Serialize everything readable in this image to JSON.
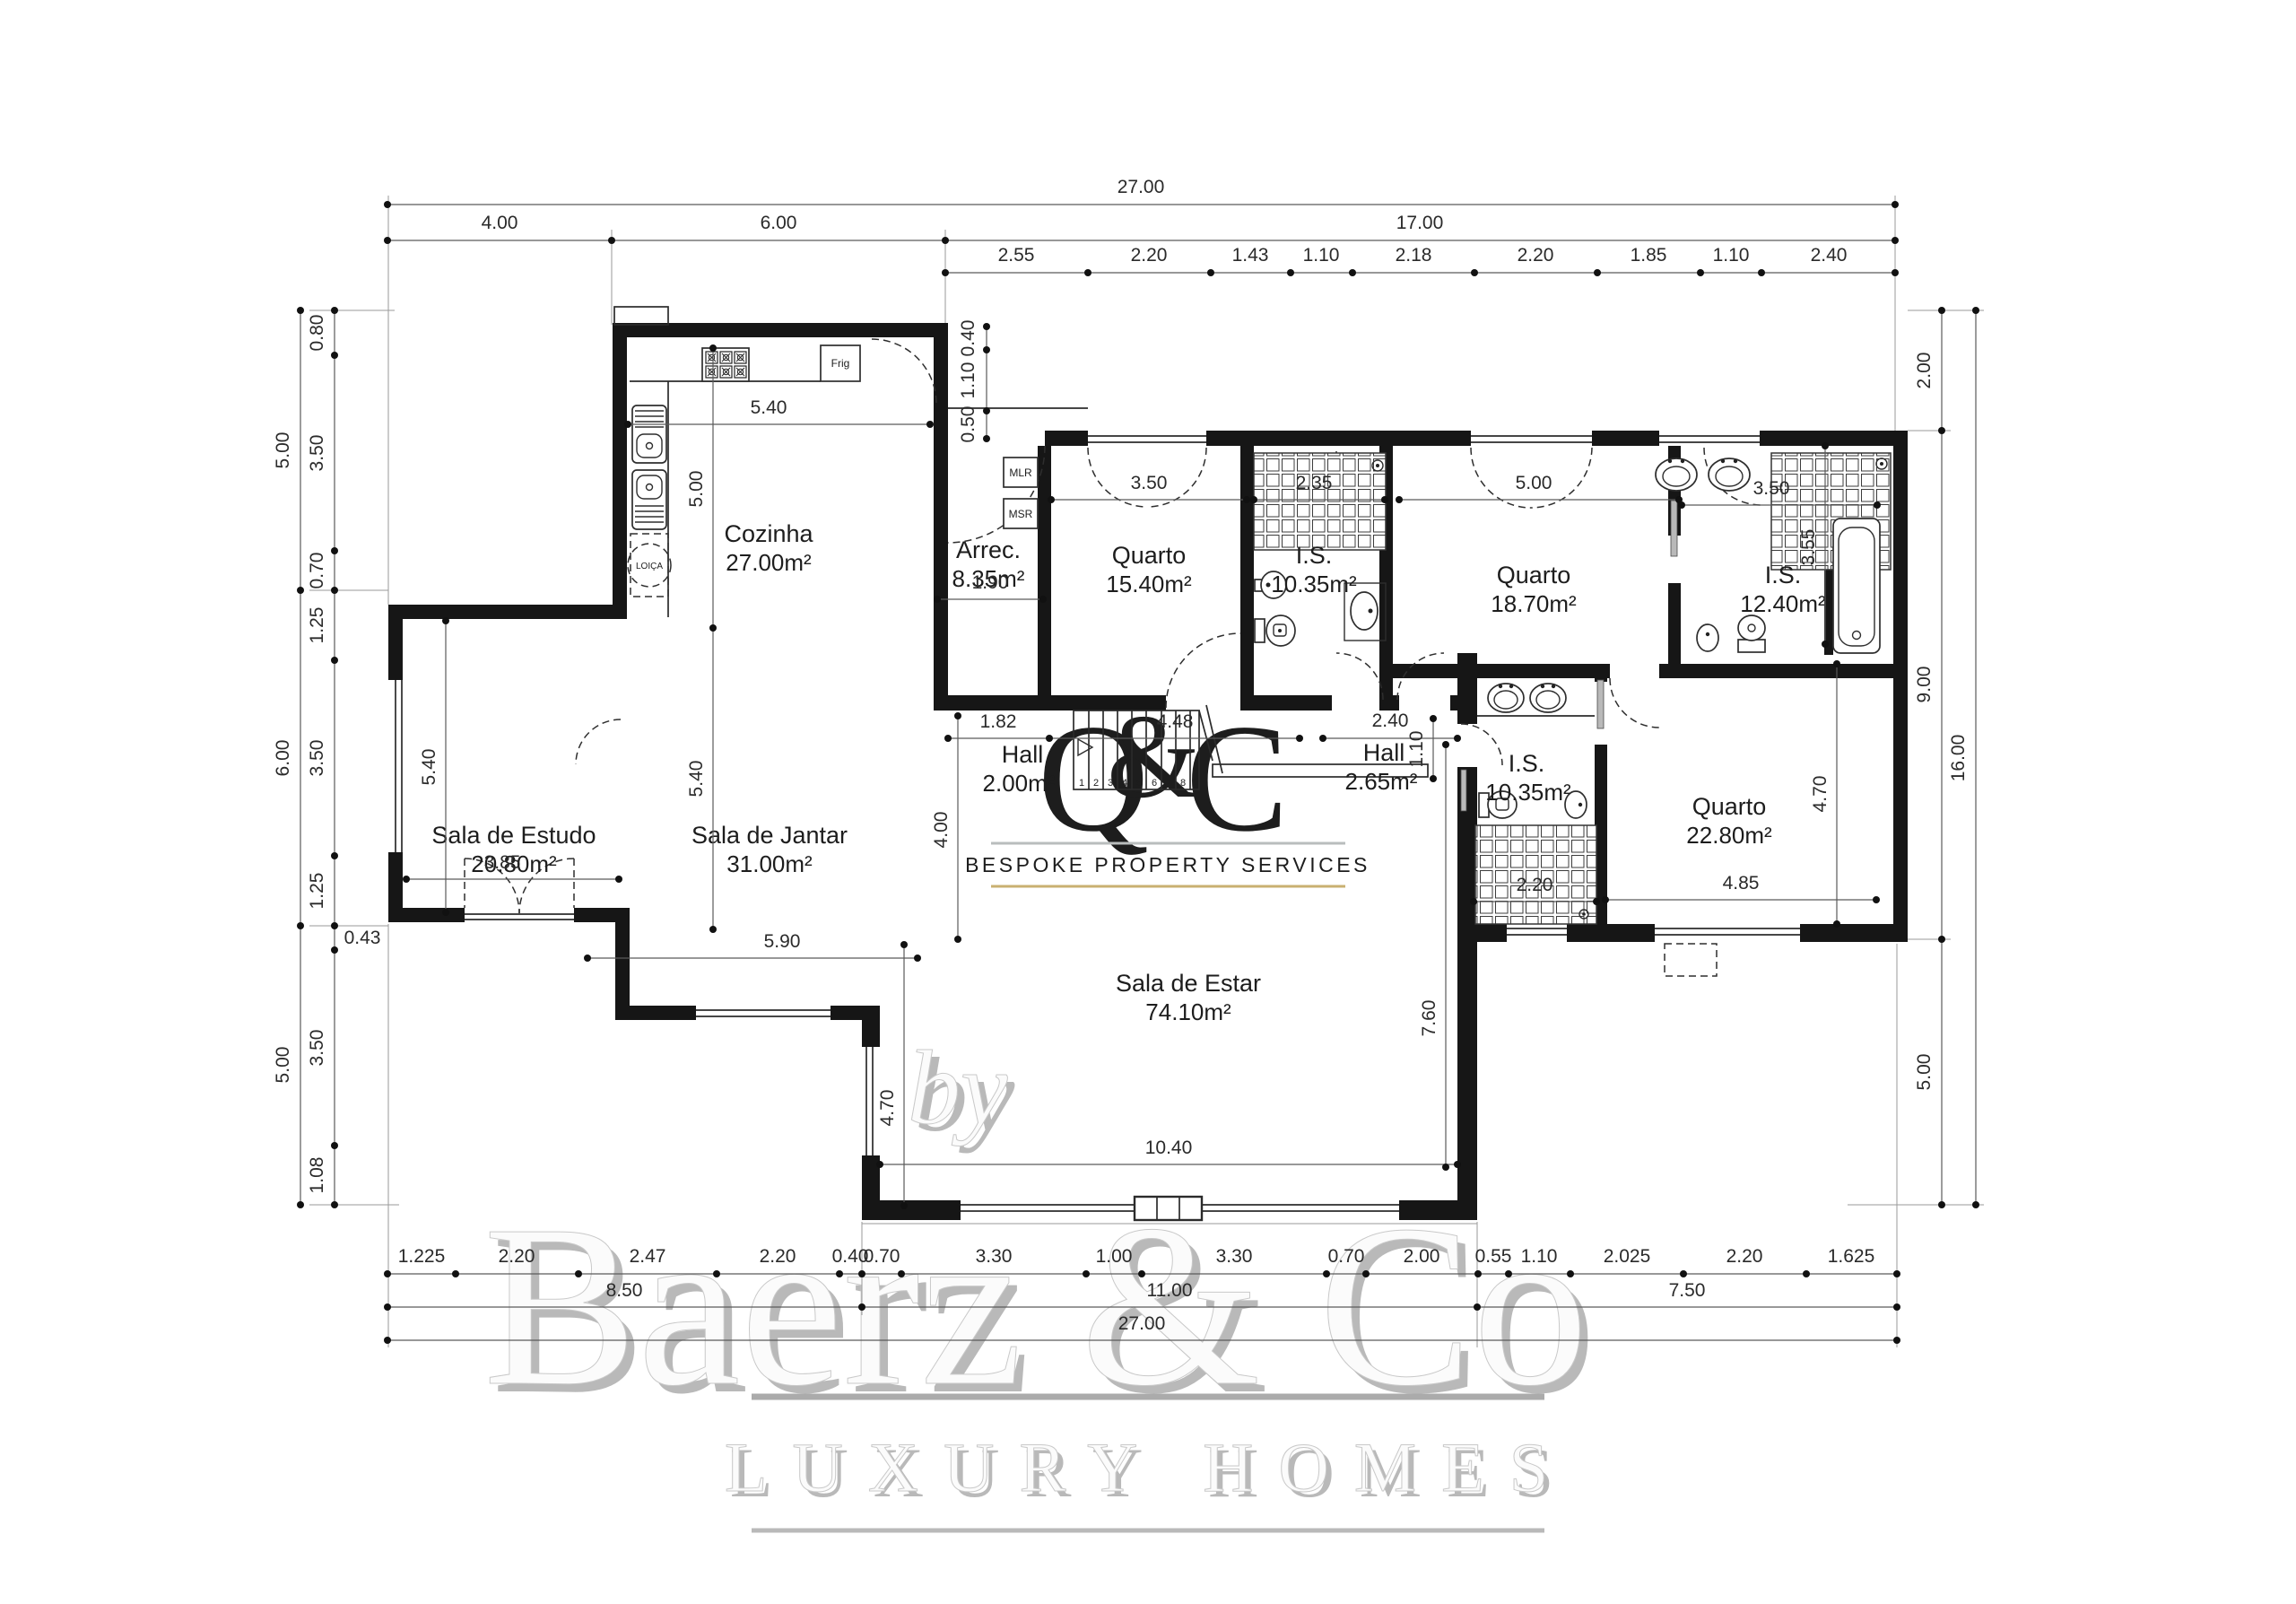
{
  "watermark": {
    "by": "by",
    "brand": "Baerz & Co",
    "tagline": "LUXURY HOMES",
    "logo": {
      "q": "Q",
      "amp": "&",
      "c": "C",
      "tagline": "BESPOKE PROPERTY SERVICES"
    },
    "colors": {
      "sage": "#93A39B",
      "gold_light": "#D8B36A",
      "gold_dark": "#A67F3B",
      "tagline_gray": "#A2ABAB",
      "rule_gray": "#B9BDBD",
      "rule_gold": "#C9B071"
    }
  },
  "rooms": {
    "cozinha": {
      "name": "Cozinha",
      "area": "27.00m²"
    },
    "arrec": {
      "name": "Arrec.",
      "area": "8.35m²"
    },
    "quarto1": {
      "name": "Quarto",
      "area": "15.40m²"
    },
    "is1": {
      "name": "I.S.",
      "area": "10.35m²"
    },
    "quarto2": {
      "name": "Quarto",
      "area": "18.70m²"
    },
    "is2": {
      "name": "I.S.",
      "area": "12.40m²"
    },
    "estudo": {
      "name": "Sala de Estudo",
      "area": "20.80m²"
    },
    "jantar": {
      "name": "Sala de Jantar",
      "area": "31.00m²"
    },
    "hall1": {
      "name": "Hall",
      "area": "2.00m²"
    },
    "hall2": {
      "name": "Hall",
      "area": "2.65m²"
    },
    "is3": {
      "name": "I.S.",
      "area": "10.35m²"
    },
    "quarto3": {
      "name": "Quarto",
      "area": "22.80m²"
    },
    "estar": {
      "name": "Sala de Estar",
      "area": "74.10m²"
    }
  },
  "fixtures": {
    "frig": "Frig",
    "mlr": "MLR",
    "msr": "MSR",
    "loica": "LOIÇA"
  },
  "stairs": {
    "steps": [
      "1",
      "2",
      "3",
      "4",
      "5",
      "6",
      "7",
      "8"
    ]
  },
  "dims": {
    "top_total": [
      "27.00"
    ],
    "top_mid": [
      "4.00",
      "6.00",
      "17.00"
    ],
    "top_detail": [
      "2.55",
      "2.20",
      "1.43",
      "1.10",
      "2.18",
      "2.20",
      "1.85",
      "1.10",
      "2.40"
    ],
    "left_outer": [
      "5.00",
      "6.00",
      "5.00"
    ],
    "left_inner": [
      "0.80",
      "3.50",
      "0.70",
      "1.25",
      "3.50",
      "1.25",
      "0.43",
      "3.50",
      "1.08"
    ],
    "right_inner": [
      "2.00",
      "9.00",
      "5.00"
    ],
    "right_outer": [
      "16.00"
    ],
    "bottom_detail": [
      "1.225",
      "2.20",
      "2.47",
      "2.20",
      "0.40",
      "0.70",
      "3.30",
      "1.00",
      "3.30",
      "0.70",
      "2.00",
      "0.55",
      "1.10",
      "2.025",
      "2.20",
      "1.625"
    ],
    "bottom_mid": [
      "8.50",
      "11.00",
      "7.50"
    ],
    "bottom_total": [
      "27.00"
    ],
    "interior": {
      "cozinha_w": "5.40",
      "cozinha_h": "5.00",
      "entry": [
        "0.40",
        "1.10",
        "0.50"
      ],
      "arrec_w": "1.90",
      "quarto1_w": "3.50",
      "is1_w": "2.35",
      "quarto2_w": "5.00",
      "is2_w": "3.50",
      "is2_h": "3.55",
      "estudo_h": "5.40",
      "estudo_door": "3.85",
      "jantar_h": "5.40",
      "jantar_w": "5.90",
      "hall1_w": "1.82",
      "hall1_mid": "4.48",
      "hall1_h": "4.00",
      "hall2_w": "2.40",
      "hall2_h": "1.10",
      "is3_w": "2.20",
      "quarto3_w": "4.85",
      "quarto3_h": "4.70",
      "estar_w": "10.40",
      "estar_h": "7.60",
      "estar_win": "4.70"
    }
  }
}
